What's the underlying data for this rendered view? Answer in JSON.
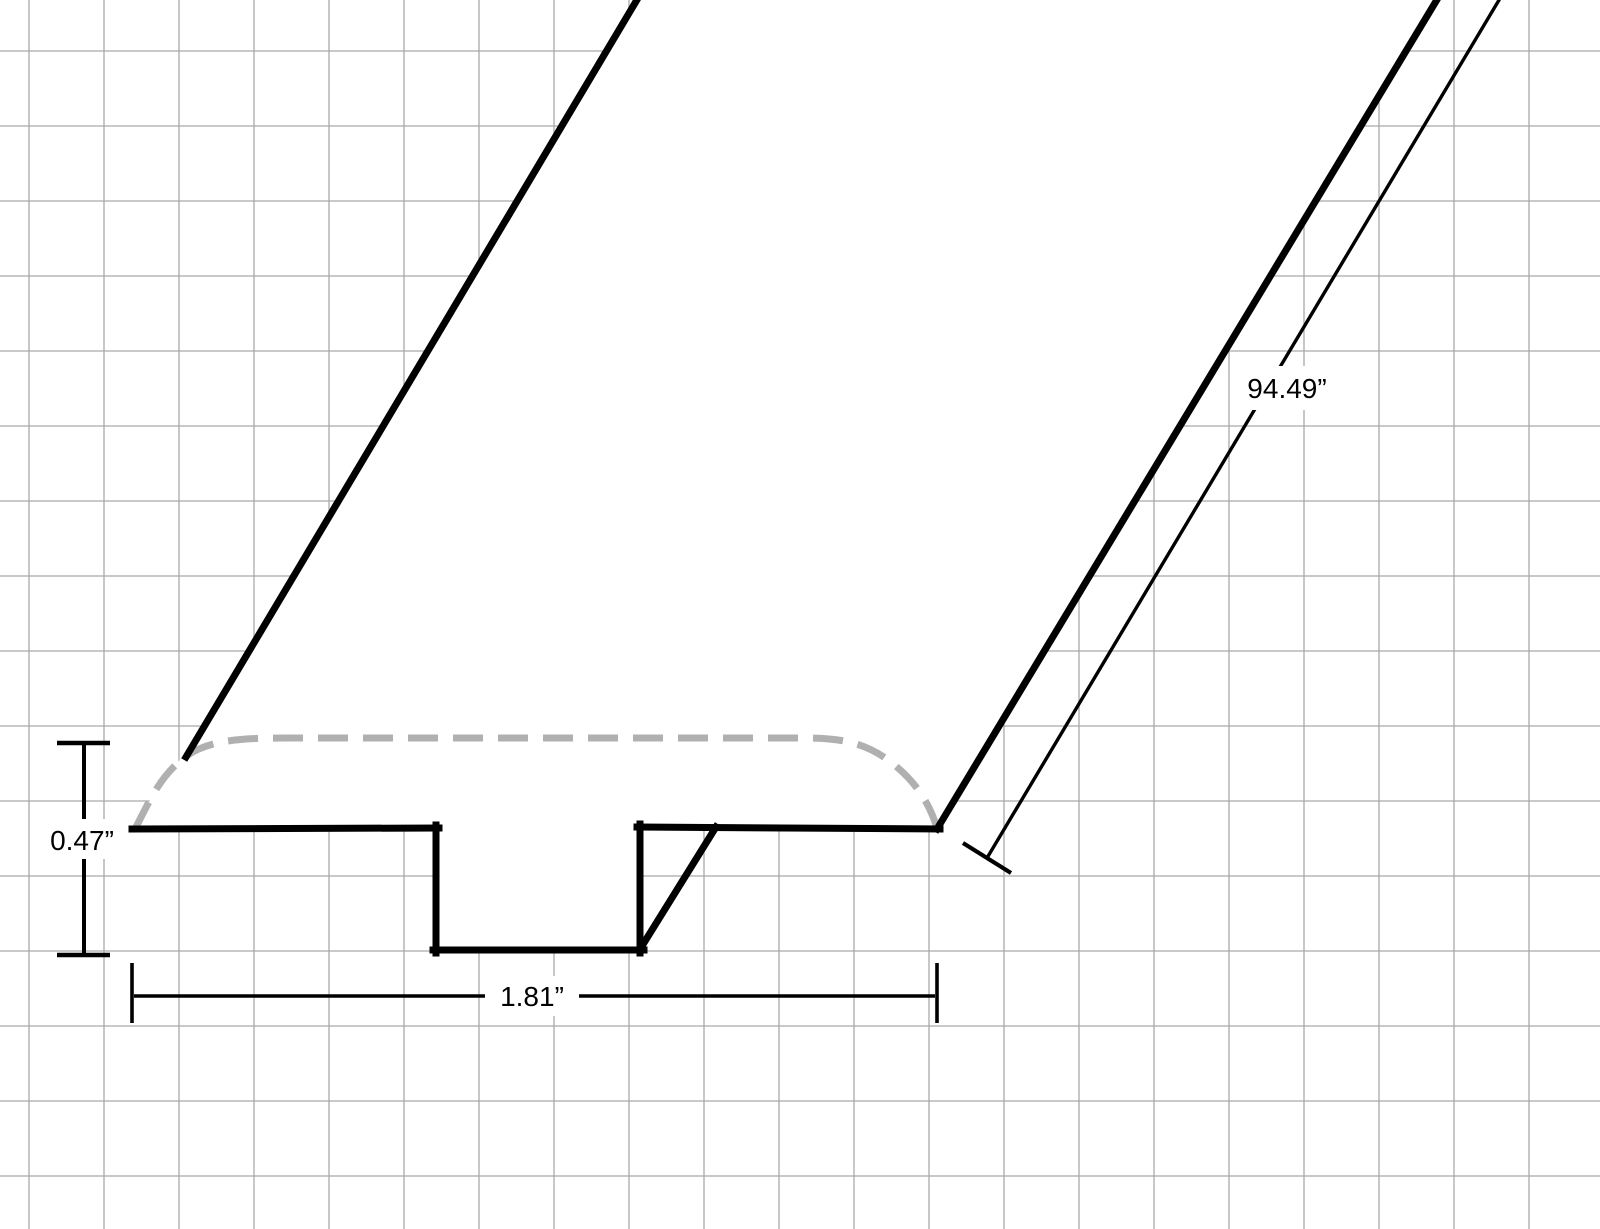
{
  "canvas": {
    "width": 1600,
    "height": 1229,
    "background": "#ffffff"
  },
  "grid": {
    "spacing": 75,
    "offset_x": 29,
    "offset_y": 51,
    "color": "#a9a9a9",
    "stroke_width": 1.3
  },
  "molding": {
    "fill": "#ffffff",
    "stroke": "#000000",
    "stroke_width": 7,
    "silhouette_path": "M 642 -12 L 1444 -12 L 937 829 L 640 827 L 640 950 L 436 950 L 436 828 L 135 829 C 151 799 161 774 186 755 Z",
    "outline_segments": [
      {
        "name": "left-edge",
        "x1": 186,
        "y1": 757,
        "x2": 644,
        "y2": -12
      },
      {
        "name": "right-edge",
        "x1": 937,
        "y1": 829,
        "x2": 1444,
        "y2": -12
      },
      {
        "name": "top-edge-left",
        "x1": 132,
        "y1": 829,
        "x2": 439,
        "y2": 828
      },
      {
        "name": "groove-left-wall",
        "x1": 436,
        "y1": 825,
        "x2": 436,
        "y2": 953
      },
      {
        "name": "groove-bottom",
        "x1": 433,
        "y1": 950,
        "x2": 644,
        "y2": 950
      },
      {
        "name": "groove-right-wall",
        "x1": 640,
        "y1": 824,
        "x2": 640,
        "y2": 953
      },
      {
        "name": "groove-depth-diagonal",
        "x1": 642,
        "y1": 946,
        "x2": 716,
        "y2": 827
      },
      {
        "name": "top-edge-right",
        "x1": 637,
        "y1": 827,
        "x2": 940,
        "y2": 829
      }
    ],
    "rounded_top": {
      "path": "M 135 829 C 150 800 160 776 185 757 C 209 739 246 738 288 738 L 806 738 C 847 738 869 745 892 763 C 915 781 929 802 937 828",
      "color": "#b0b0b0",
      "width": 7,
      "dash": "30 15"
    }
  },
  "dimensions": {
    "height": {
      "label": "0.47”",
      "lines": [
        {
          "x1": 84,
          "y1": 743,
          "x2": 84,
          "y2": 955,
          "w": 4
        }
      ],
      "ticks": [
        {
          "x1": 57,
          "y1": 743,
          "x2": 110,
          "y2": 743,
          "w": 4.5
        },
        {
          "x1": 57,
          "y1": 955,
          "x2": 110,
          "y2": 955,
          "w": 4.5
        }
      ],
      "mask": {
        "x": 42,
        "y": 819,
        "w": 80,
        "h": 40
      },
      "label_pos": {
        "x": 82,
        "y": 850
      }
    },
    "width": {
      "label": "1.81”",
      "lines": [
        {
          "x1": 134,
          "y1": 996,
          "x2": 935,
          "y2": 996,
          "w": 3.6
        }
      ],
      "ticks": [
        {
          "x1": 132,
          "y1": 963,
          "x2": 132,
          "y2": 1023,
          "w": 3.6
        },
        {
          "x1": 937,
          "y1": 963,
          "x2": 937,
          "y2": 1023,
          "w": 3.6
        }
      ],
      "mask": {
        "x": 485,
        "y": 976,
        "w": 94,
        "h": 40
      },
      "label_pos": {
        "x": 532,
        "y": 1006
      }
    },
    "length": {
      "label": "94.49”",
      "lines": [
        {
          "x1": 1505,
          "y1": -10,
          "x2": 987,
          "y2": 858,
          "w": 3.4
        }
      ],
      "ticks": [
        {
          "x1": 963,
          "y1": 843,
          "x2": 1011,
          "y2": 873,
          "w": 4.2
        }
      ],
      "mask": {
        "x": 1231,
        "y": 366,
        "w": 112,
        "h": 44
      },
      "label_pos": {
        "x": 1287,
        "y": 398
      }
    }
  }
}
